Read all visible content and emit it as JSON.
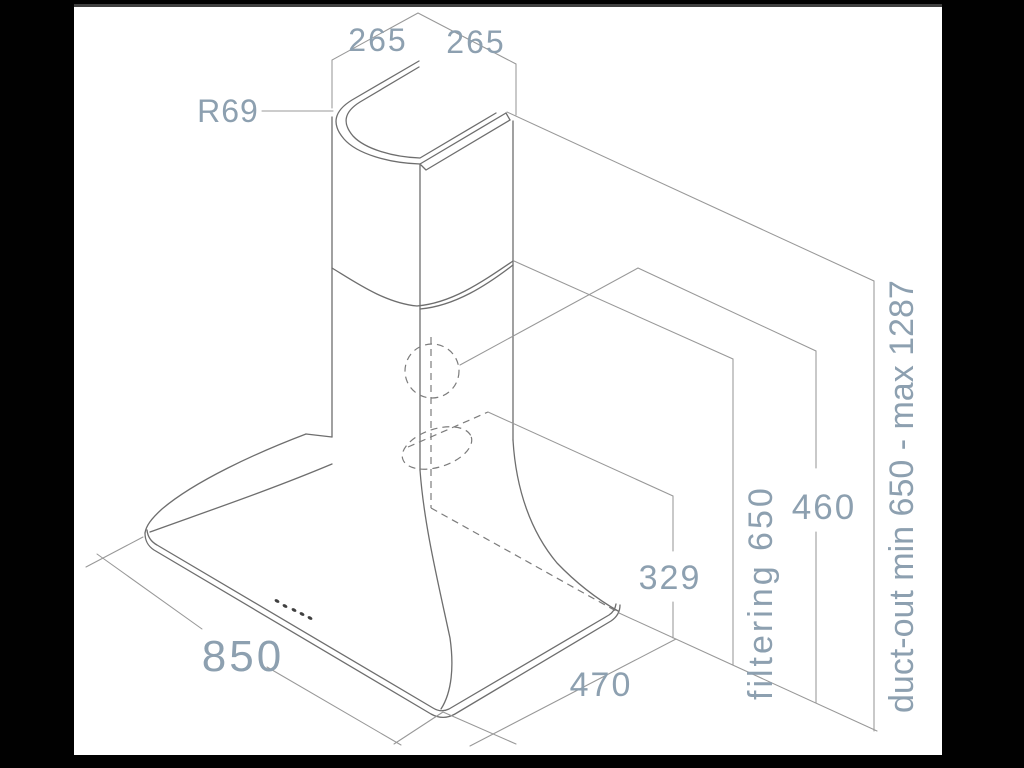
{
  "drawing": {
    "subject": "cooker-hood-dimension-drawing",
    "labels": {
      "top_width": "265",
      "top_depth": "265",
      "corner_radius": "R69",
      "base_width": "850",
      "base_depth": "470",
      "rear_outlet_height": "329",
      "top_outlet_height": "460",
      "filtering_height": "filtering 650",
      "ducting_height": "duct-out min 650 - max 1287"
    },
    "colors": {
      "label_text": "#8da0b0",
      "object_line": "#6e6e6e",
      "dashed_line": "#7c7c7c",
      "dimension_line": "#989898",
      "paper": "#ffffff",
      "backdrop": "#010101"
    }
  }
}
